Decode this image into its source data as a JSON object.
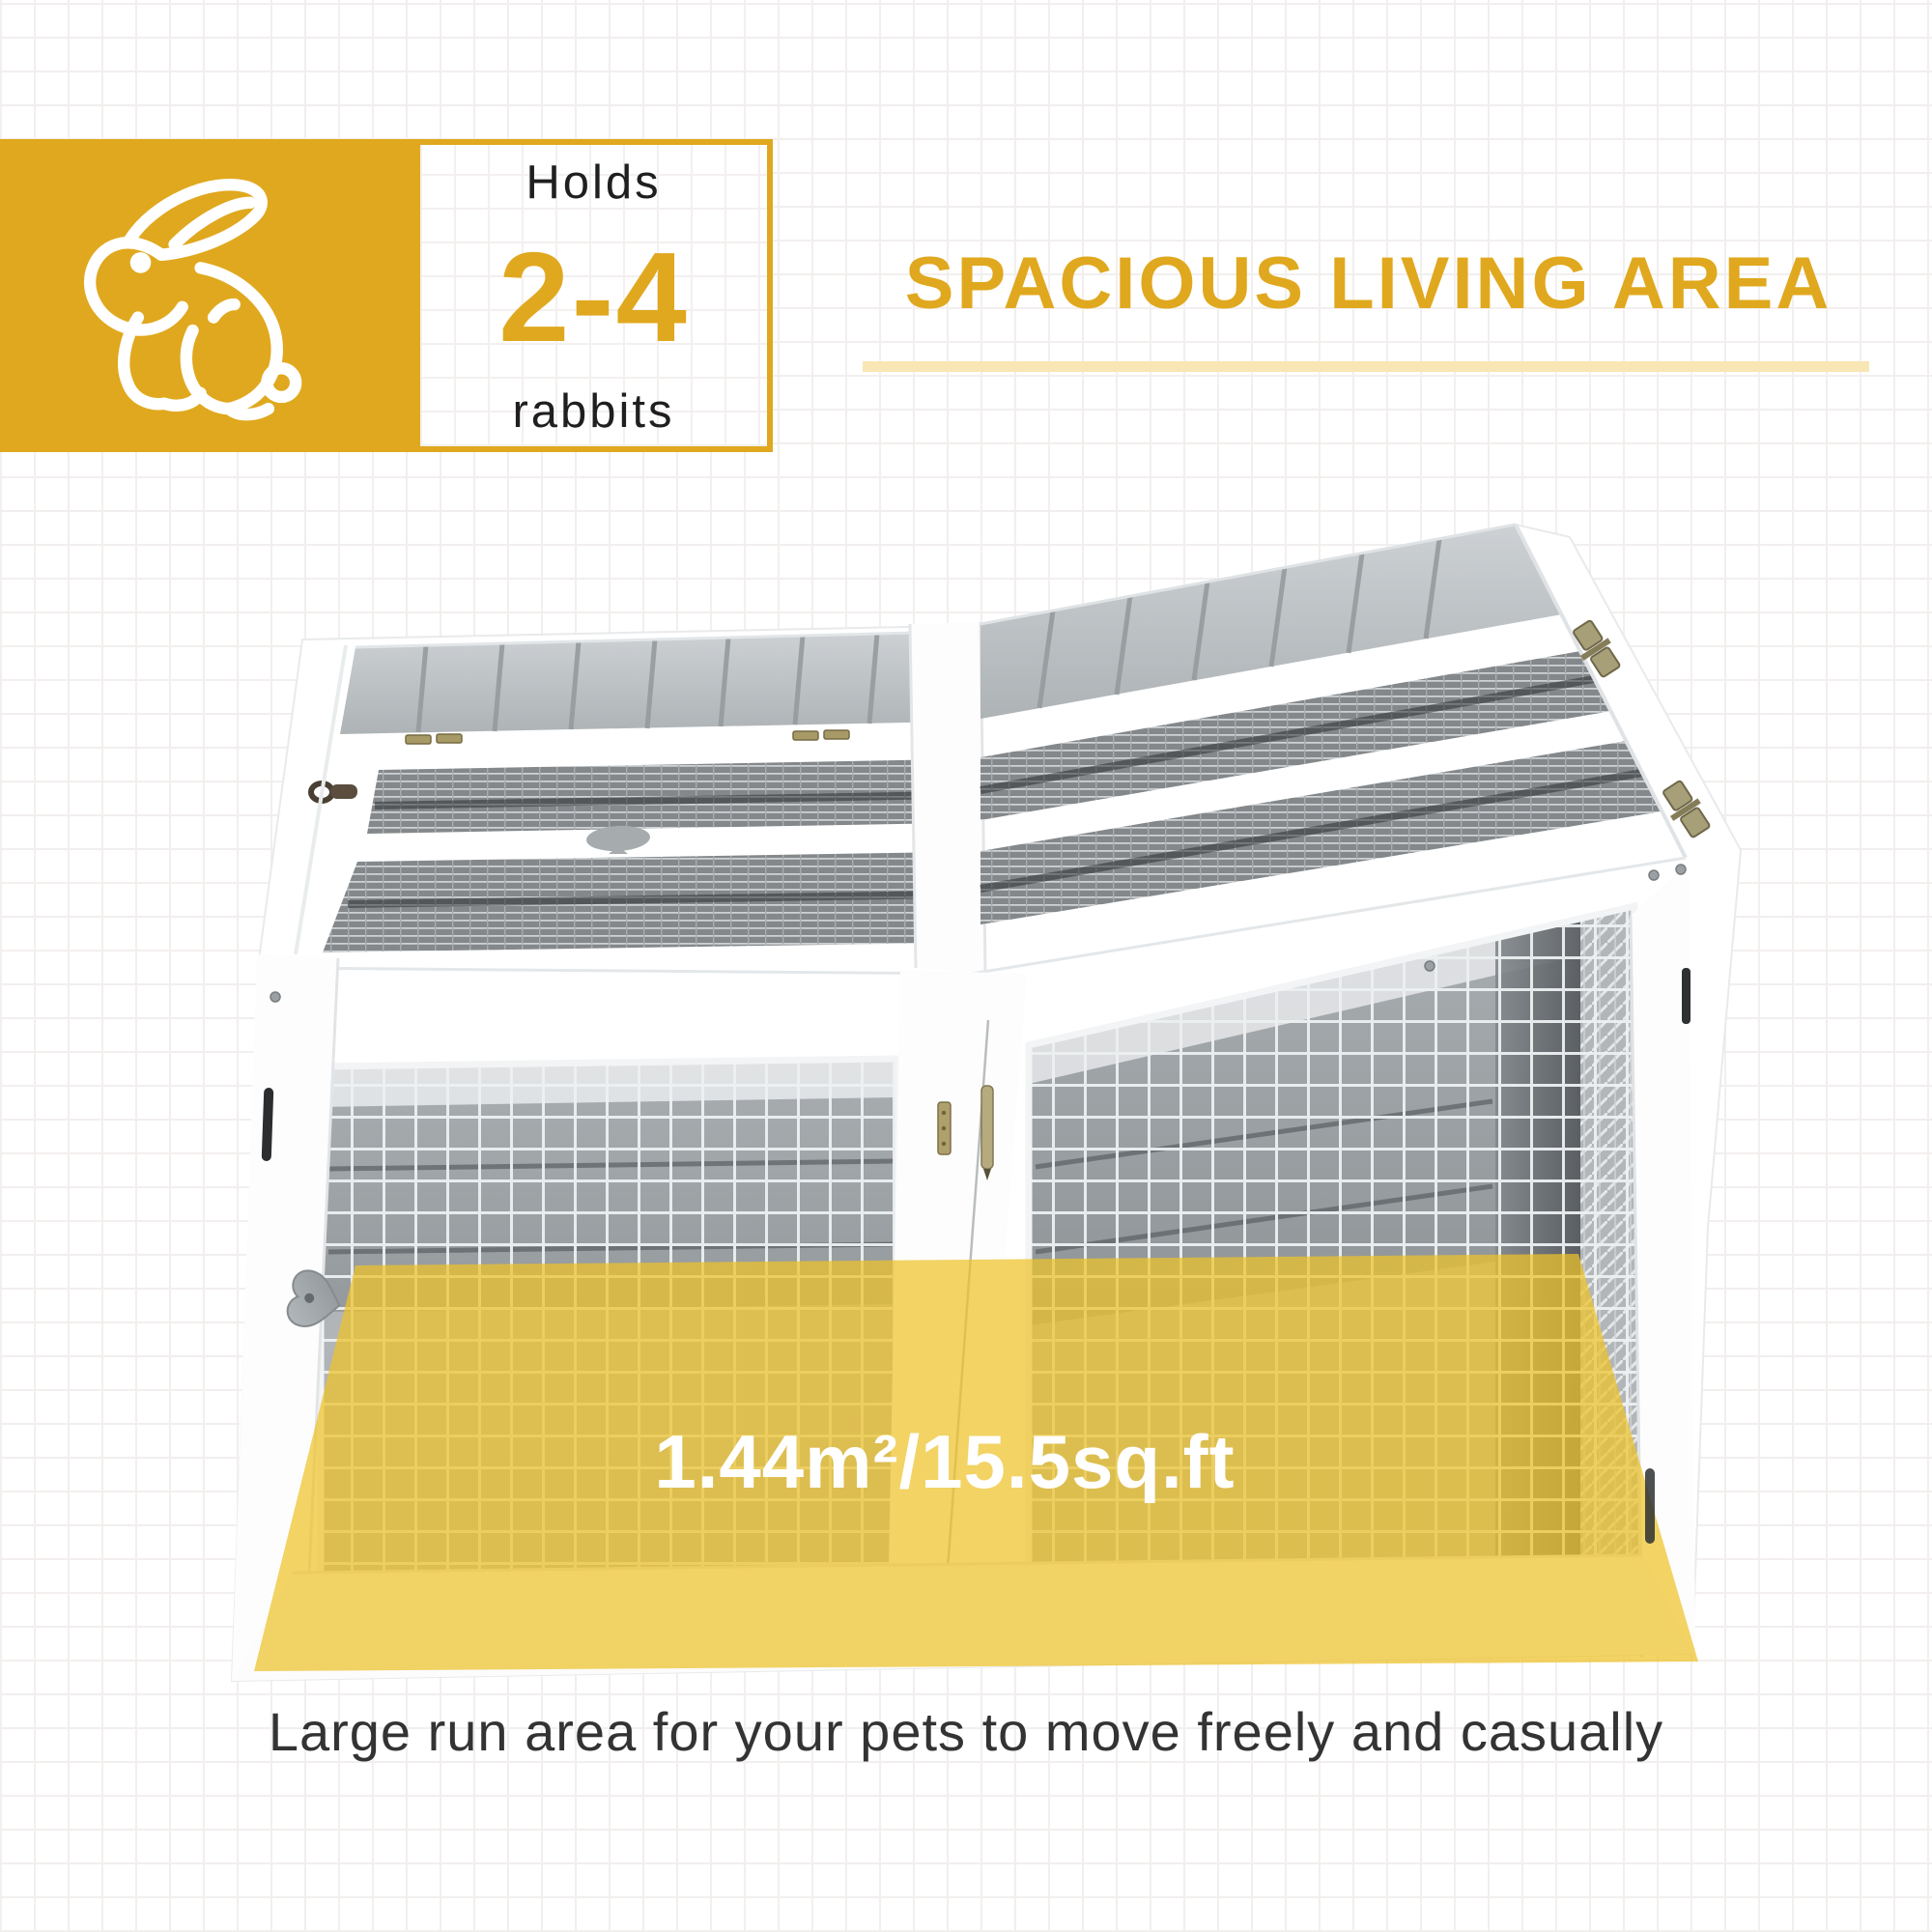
{
  "badge": {
    "holds_label": "Holds",
    "range_label": "2-4",
    "animal_label": "rabbits",
    "icon": "rabbit-outline-icon"
  },
  "heading": {
    "title": "SPACIOUS LIVING AREA"
  },
  "overlay": {
    "area_label": "1.44m²/15.5sq.ft"
  },
  "caption": {
    "text": "Large run area for your pets to move freely and casually"
  },
  "colors": {
    "brand_yellow": "#E0A81E",
    "underline_yellow": "#F8E7B4",
    "overlay_yellow": "#EDC32A",
    "roof_wood_gray": "#C3C7CA",
    "mesh_gray": "#84888B",
    "caption_gray": "#333333",
    "white": "#FFFFFF"
  }
}
